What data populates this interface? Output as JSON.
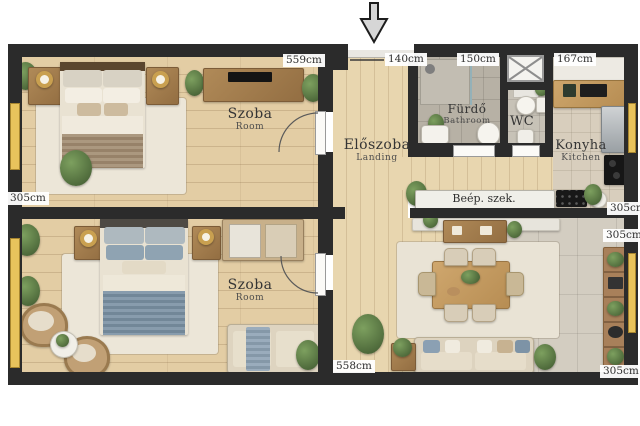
{
  "plan": {
    "rooms": {
      "bedroom1": {
        "name": "Szoba",
        "sub": "Room"
      },
      "bedroom2": {
        "name": "Szoba",
        "sub": "Room"
      },
      "hallway": {
        "name": "Előszoba",
        "sub": "Landing"
      },
      "bathroom": {
        "name": "Fürdő",
        "sub": "Bathroom"
      },
      "wc": {
        "name": "WC"
      },
      "kitchen": {
        "name": "Konyha",
        "sub": "Kitchen"
      }
    },
    "dims": {
      "bedroom1_width": "559cm",
      "entrance": "140cm",
      "bathroom": "150cm",
      "kitchen": "167cm",
      "bedroom1_depth": "305cm",
      "kitchen_depth": "305cm",
      "living_top": "305cm",
      "living_width": "558cm",
      "living_depth": "305cm"
    },
    "fixtures": {
      "built_in_wardrobe": "Beép. szek."
    },
    "icons": {
      "entrance_arrow": "down-arrow"
    },
    "colors": {
      "wall": "#2b2b2b",
      "window_accent": "#e8c35c",
      "floor_wood": "#e3cda4",
      "floor_tile": "#d3cdc1",
      "floor_bath": "#b7b1a5",
      "bed_blue": "#7b91a4",
      "bed_taupe": "#a28c71",
      "label_text": "#2e2e2e"
    }
  }
}
